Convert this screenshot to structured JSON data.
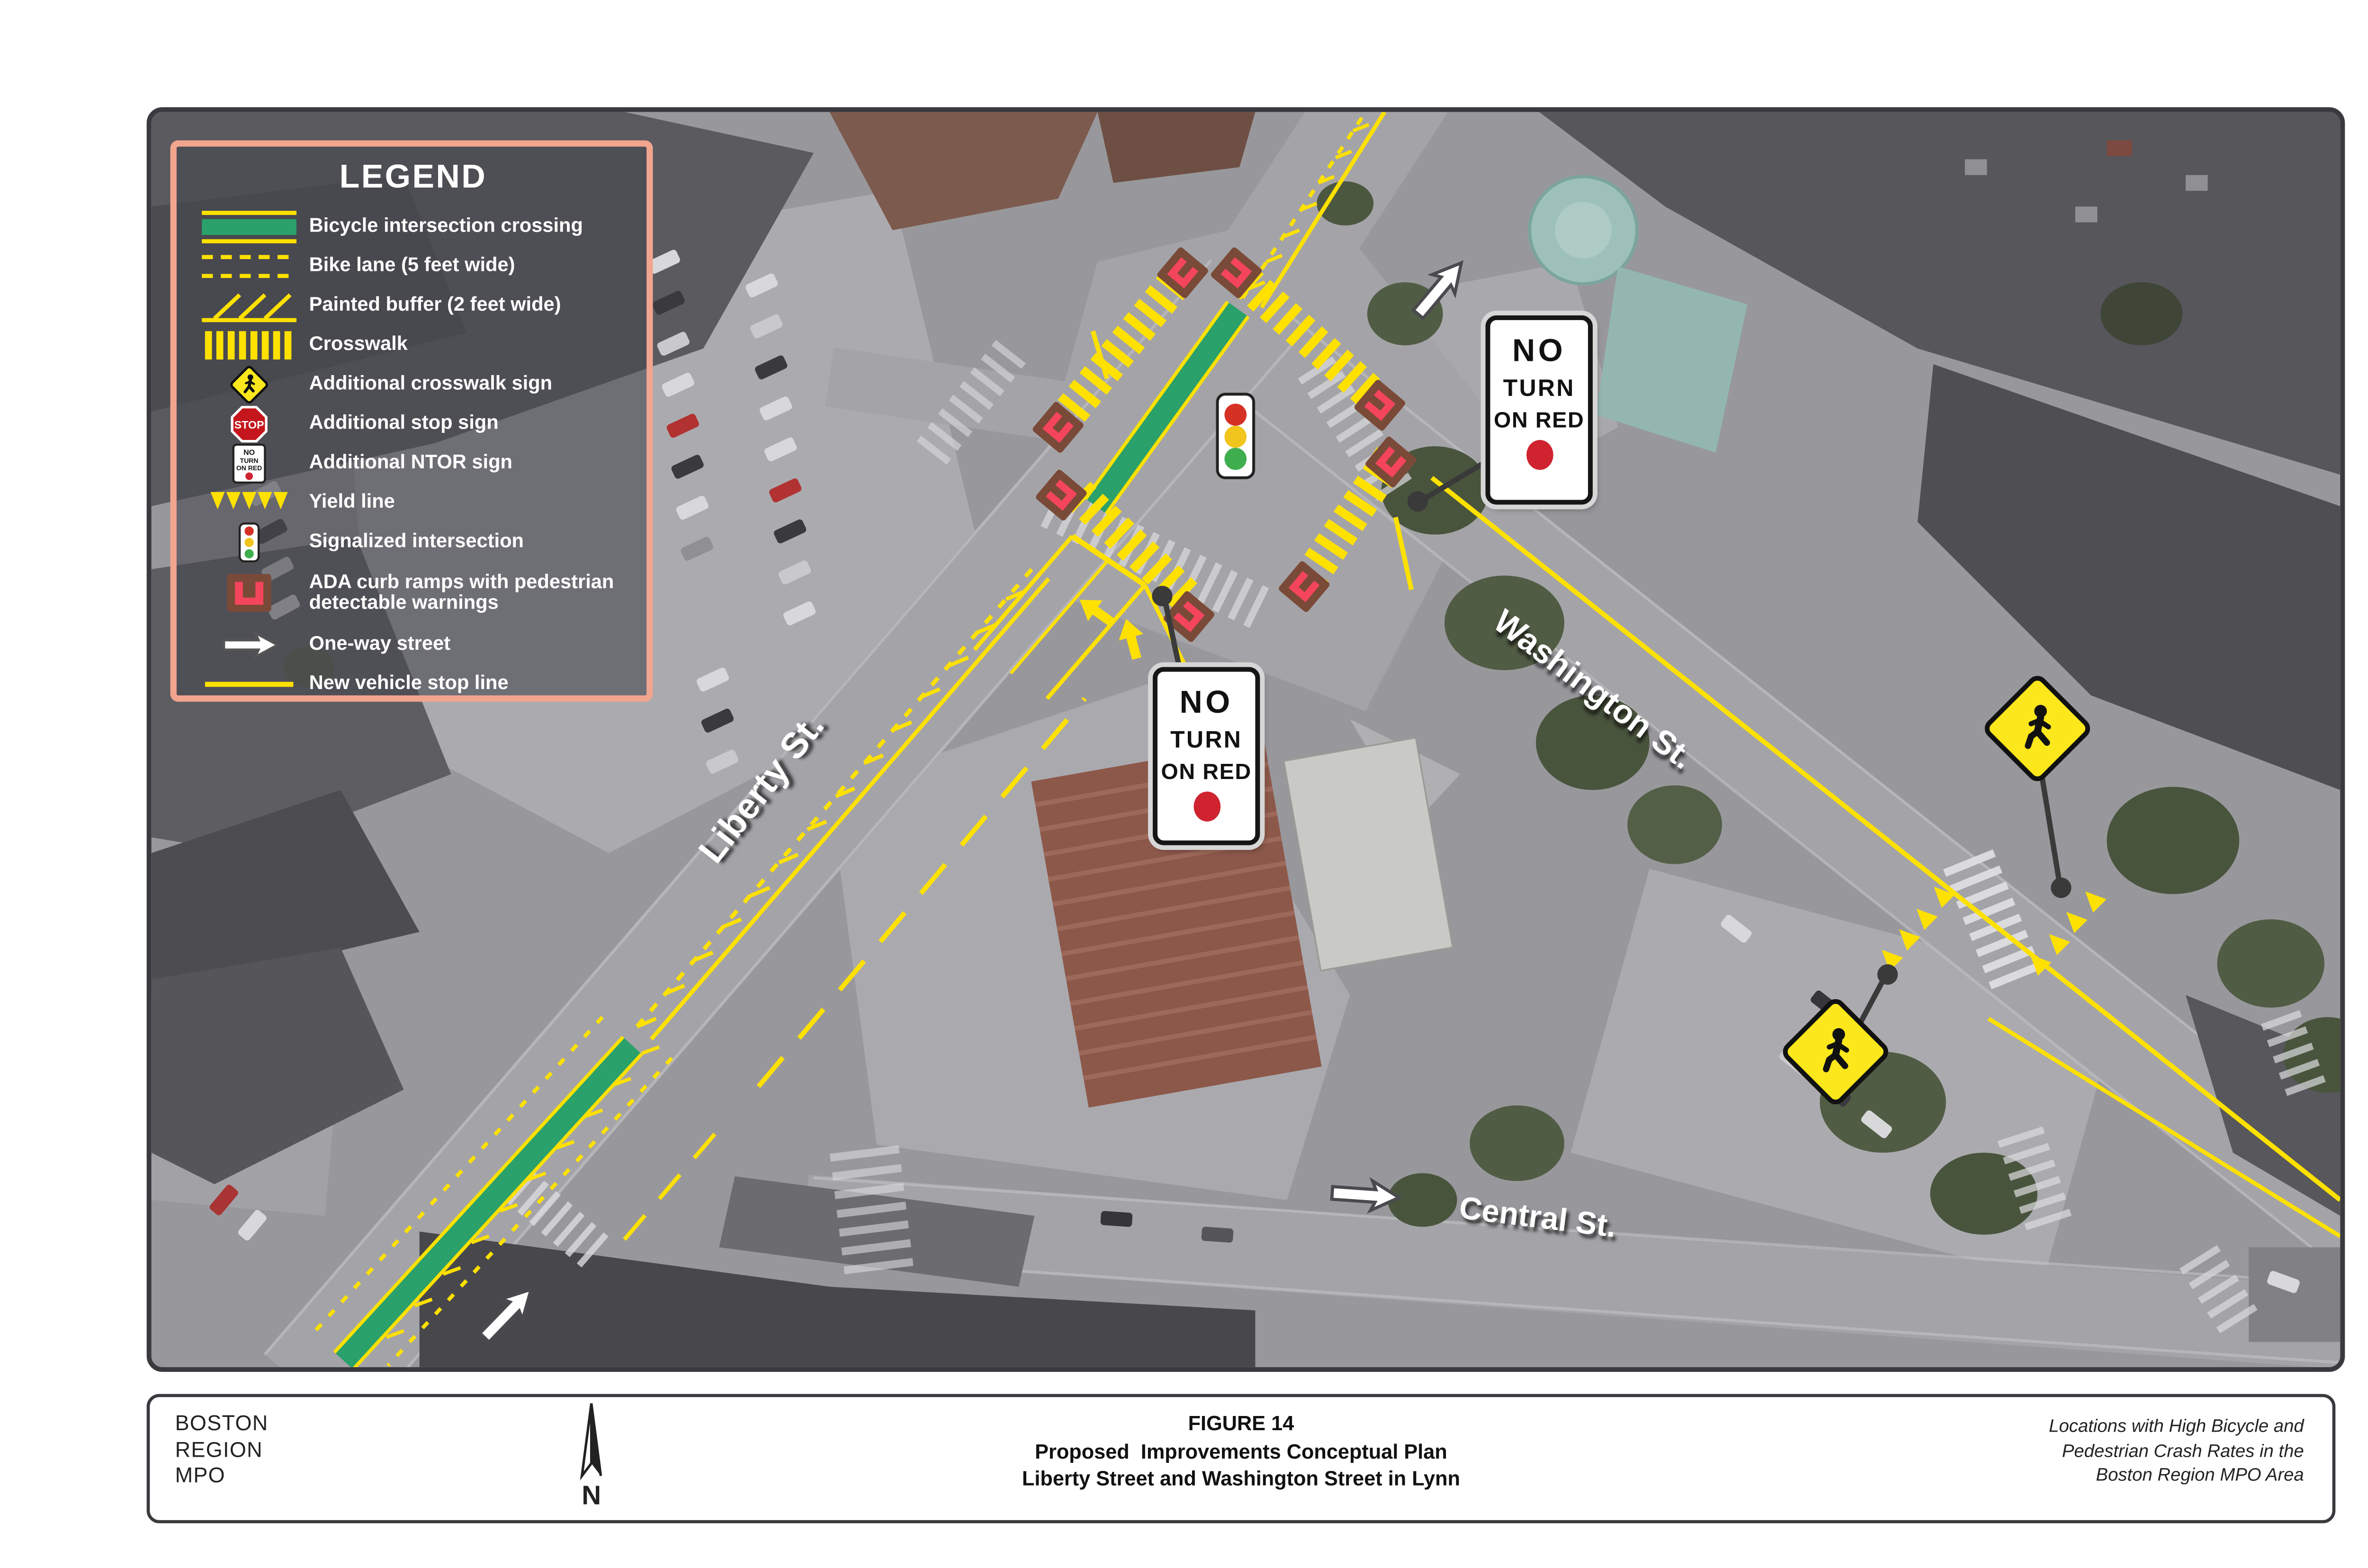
{
  "colors": {
    "marking_yellow": "#FFE100",
    "bike_green": "#2AA06B",
    "ramp_red": "#F5455C",
    "ramp_brown": "#7A4A38",
    "legend_border": "#F2A58E",
    "signal_red": "#D63125",
    "signal_yellow": "#F2C51D",
    "signal_green": "#3FAE4E",
    "ntor_dot_red": "#CF2330",
    "ped_sign_yellow": "#FBE71C"
  },
  "legend": {
    "title": "LEGEND",
    "items": [
      {
        "icon": "bicycle-crossing-swatch",
        "label": "Bicycle intersection crossing"
      },
      {
        "icon": "bike-lane-swatch",
        "label": "Bike lane (5 feet wide)"
      },
      {
        "icon": "painted-buffer-swatch",
        "label": "Painted buffer (2 feet wide)"
      },
      {
        "icon": "crosswalk-swatch",
        "label": "Crosswalk"
      },
      {
        "icon": "crosswalk-sign-icon",
        "label": "Additional crosswalk sign"
      },
      {
        "icon": "stop-sign-icon",
        "label": "Additional stop sign"
      },
      {
        "icon": "ntor-sign-icon",
        "label": "Additional NTOR sign"
      },
      {
        "icon": "yield-line-swatch",
        "label": "Yield line"
      },
      {
        "icon": "traffic-signal-icon",
        "label": "Signalized intersection"
      },
      {
        "icon": "ada-ramp-icon",
        "label": "ADA curb ramps with pedestrian detectable warnings"
      },
      {
        "icon": "one-way-arrow-icon",
        "label": "One-way street"
      },
      {
        "icon": "stop-line-swatch",
        "label": "New vehicle stop line"
      }
    ],
    "stop_sign_text": "STOP",
    "ntor_mini_lines": [
      "NO",
      "TURN",
      "ON RED"
    ]
  },
  "map": {
    "street_labels": {
      "liberty": "Liberty St.",
      "washington": "Washington St.",
      "central": "Central St."
    },
    "ntor_sign": {
      "line1": "NO",
      "line2": "TURN",
      "line3": "ON RED"
    }
  },
  "footer": {
    "agency_lines": [
      "BOSTON",
      "REGION",
      "MPO"
    ],
    "north_label": "N",
    "title_lines": [
      "FIGURE 14",
      "Proposed  Improvements Conceptual Plan",
      "Liberty Street and Washington Street in Lynn"
    ],
    "note_lines": [
      "Locations with High Bicycle and",
      "Pedestrian Crash Rates in the",
      "Boston Region MPO Area"
    ]
  }
}
